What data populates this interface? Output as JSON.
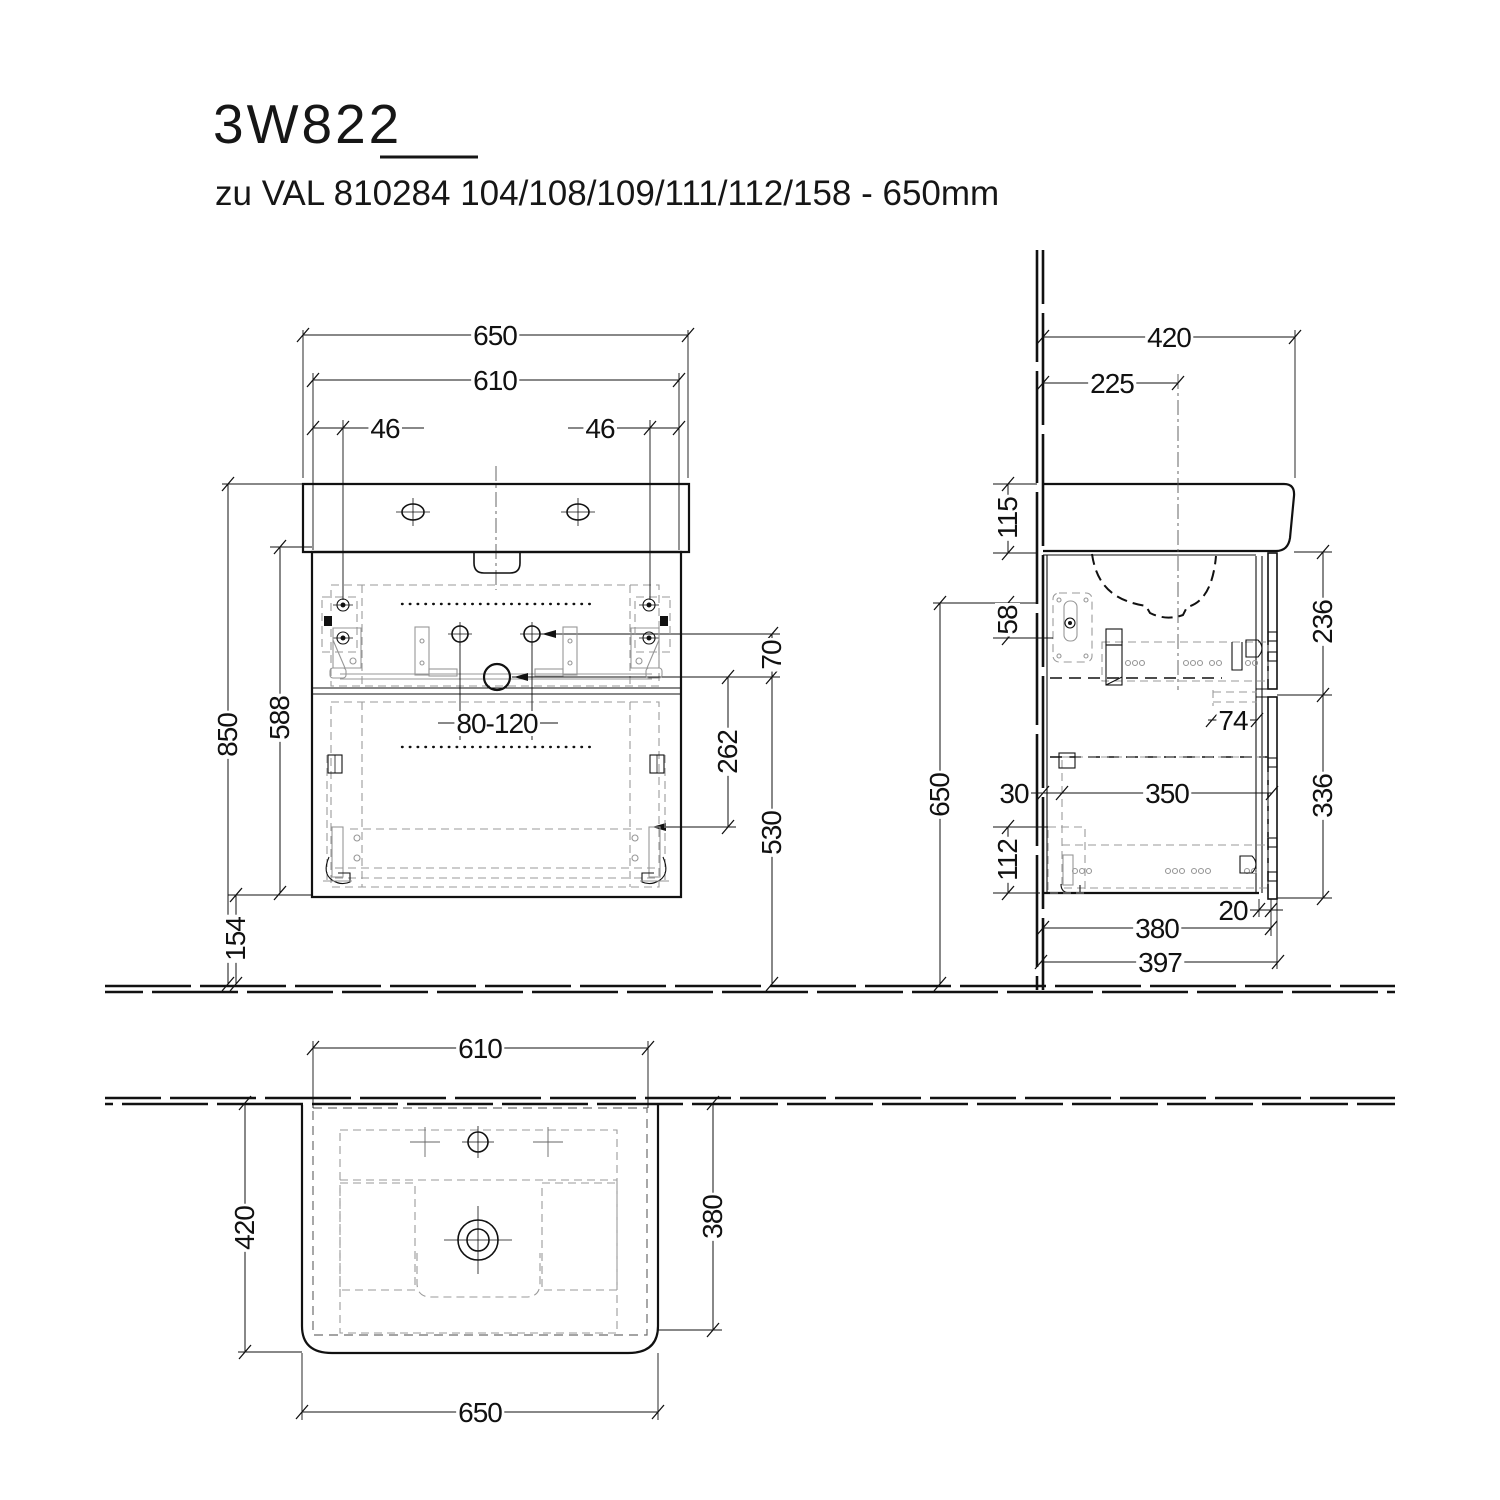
{
  "title": "3W822",
  "subtitle": "zu VAL 810284 104/108/109/111/112/158 - 650mm",
  "dims": {
    "front_width_overall": "650",
    "front_width_cabinet": "610",
    "front_hole_offset_left": "46",
    "front_hole_offset_right": "46",
    "front_height_total": "850",
    "front_height_cabinet": "588",
    "front_bottom_clearance": "154",
    "front_drain_range": "80-120",
    "front_knob_drain_gap": "70",
    "front_drain_bracket": "262",
    "front_drain_height": "530",
    "side_depth_overall": "420",
    "side_hole_to_wall": "225",
    "side_basin_height": "115",
    "side_rail_offset": "58",
    "side_height": "650",
    "side_upper_front_height": "236",
    "side_drawer_gap": "74",
    "side_back_clearance": "30",
    "side_drawer_depth": "350",
    "side_lower_front_height": "336",
    "side_slide_height": "112",
    "side_front_thickness": "20",
    "side_carcass_depth": "380",
    "side_total_depth": "397",
    "top_width_cabinet": "610",
    "top_depth_overall": "420",
    "top_depth_cabinet": "380",
    "top_width_overall": "650"
  }
}
